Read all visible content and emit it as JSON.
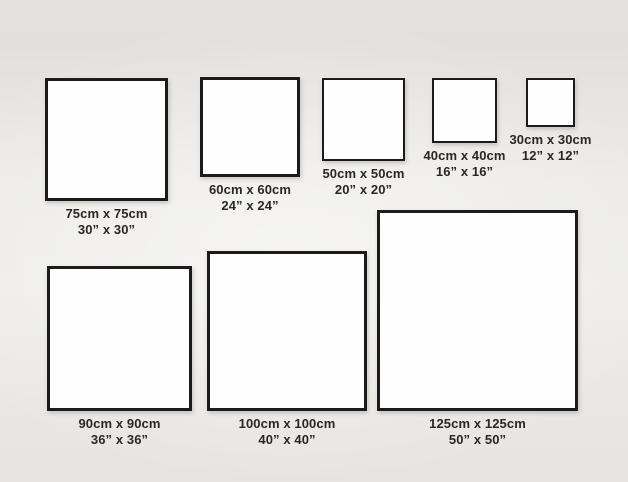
{
  "diagram": {
    "description": "Square canvas / frame size comparison chart",
    "unit_primary": "cm",
    "unit_secondary": "inches"
  },
  "colors": {
    "background": "#eceae8",
    "frame_fill": "#fefefe",
    "frame_border": "#1b1b1b",
    "label_text": "#2b2728"
  },
  "frames": [
    {
      "cm": "75cm x 75cm",
      "inches": "30” x 30”"
    },
    {
      "cm": "60cm x 60cm",
      "inches": "24” x 24”"
    },
    {
      "cm": "50cm x 50cm",
      "inches": "20” x 20”"
    },
    {
      "cm": "40cm x 40cm",
      "inches": "16” x 16”"
    },
    {
      "cm": "30cm x 30cm",
      "inches": "12” x 12”"
    },
    {
      "cm": "90cm x 90cm",
      "inches": "36” x 36”"
    },
    {
      "cm": "100cm x 100cm",
      "inches": "40” x 40”"
    },
    {
      "cm": "125cm x 125cm",
      "inches": "50” x 50”"
    }
  ]
}
